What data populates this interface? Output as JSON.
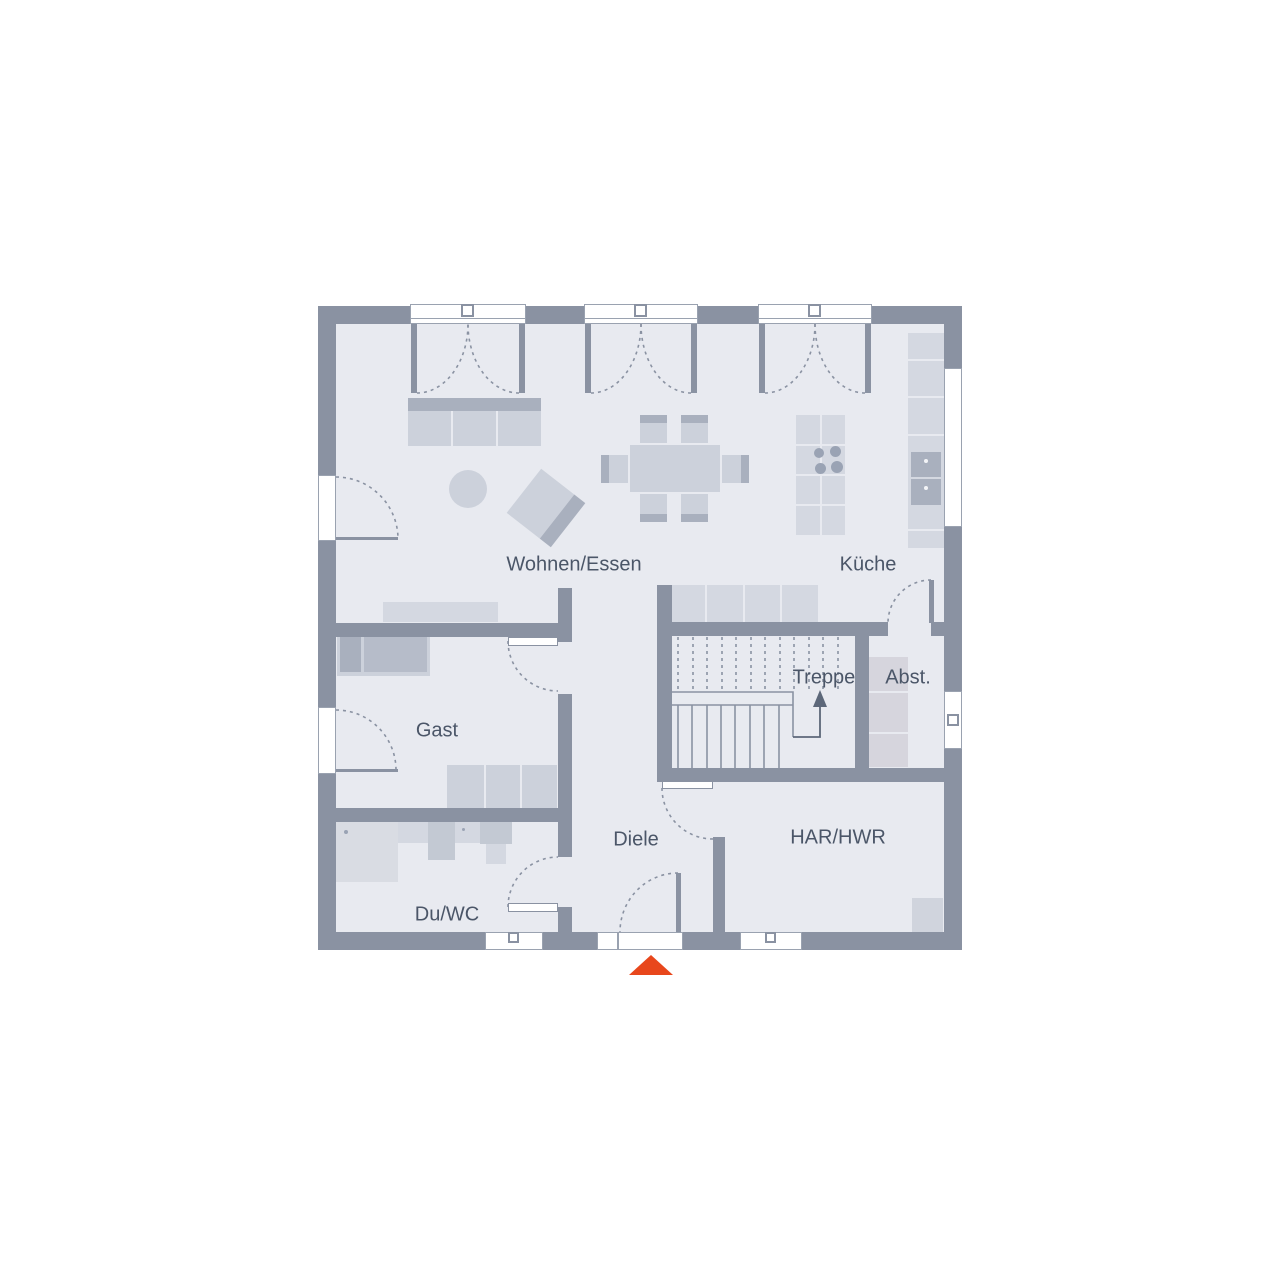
{
  "plan": {
    "kind": "residential-floor-plan",
    "rooms": {
      "wohnen_essen": {
        "label": "Wohnen/Essen"
      },
      "kueche": {
        "label": "Küche"
      },
      "treppe": {
        "label": "Treppe"
      },
      "abst": {
        "label": "Abst."
      },
      "gast": {
        "label": "Gast"
      },
      "diele": {
        "label": "Diele"
      },
      "har_hwr": {
        "label": "HAR/HWR"
      },
      "du_wc": {
        "label": "Du/WC"
      }
    },
    "colors": {
      "wall": "#8a92a2",
      "floor": "#e8eaf0",
      "furniture": "#ccd1db",
      "furniture_dark": "#a9b0be",
      "entrance_accent": "#e8471c",
      "label_text": "#4b5668"
    },
    "markers": {
      "entrance": "orange-triangle-pointing-up",
      "stair_direction": "arrow-up"
    }
  }
}
